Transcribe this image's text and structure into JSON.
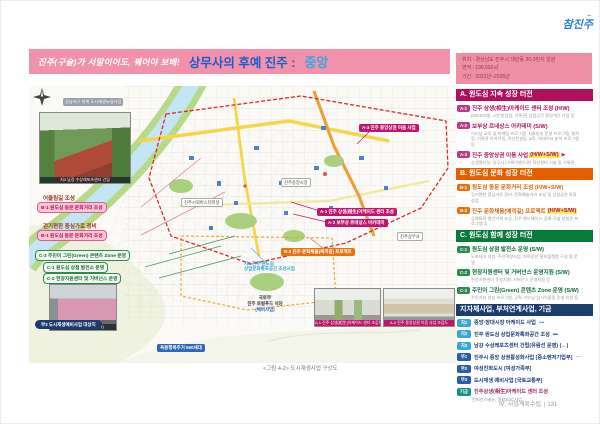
{
  "logo": {
    "text": "참진주"
  },
  "header": {
    "slogan": "진주(구슬)가 서말이어도, 꿰어야 보배!",
    "title": "상무사의 후예 진주 :",
    "title_highlight": "중앙",
    "info": {
      "lines": [
        "위치 : 경상남도 진주시 대안동 30-3번지 일원",
        "면적 : 199,692㎡",
        "기간 : 2022년~2026년"
      ]
    }
  },
  "panel": {
    "a": {
      "title": "A. 원도심 지속 성장 터전",
      "items": [
        {
          "badge": "A-1",
          "title": "진주 상생(相生)아케이드 센터 조성 (H/W)",
          "hl": "",
          "mark": "",
          "desc": "(MICE지원, 시민창업샵, 기록관) 상업공간 환경개선 사업 등"
        },
        {
          "badge": "A-2",
          "title": "보부상 르네상스 아카데미 (S/W)",
          "hl": "",
          "mark": "",
          "desc": "이러닝 교육 및 마케팅 프로그램, 자율방송 운영 프로그램, 컬처링, 기록관 아카이빙, 혁신컨설팅 교육, 빅데이터 분석 프로그램 등"
        },
        {
          "badge": "A-3",
          "title": "진주 중앙상권 이음 사업",
          "hl": "(H/W+S/W)",
          "mark": "▶",
          "desc": "상생멀티실, 상무사 (기록이벤트관) 혁신센터 시설 및 기록관"
        }
      ]
    },
    "b": {
      "title": "B. 원도심 문화 성장 터전",
      "items": [
        {
          "badge": "B-1",
          "title": "원도심 동문 문화거리 조성 (H/W+S/W)",
          "hl": "",
          "mark": "",
          "desc": "걷기편한 중심가로 정비, 문화예술거리 조성 및 상설공연 특화상점"
        },
        {
          "badge": "B-2",
          "title": "진주 문화채움(예끼길) 프로젝트",
          "hl": "(H/W+S/W)",
          "mark": "",
          "desc": "공예특화 청년가게 조성, 진주 핸드메이드·공예·구슬 실험존 프로그램 등"
        }
      ]
    },
    "c": {
      "title": "C. 원도심 함께 성장 터전",
      "items": [
        {
          "badge": "C-1",
          "title": "원도심 상점 발전소 운영 (S/W)",
          "hl": "",
          "mark": "",
          "desc": "노포테크 지원, 주민역량사업, 지역상인 홍보플랫폼 구성 및 운영"
        },
        {
          "badge": "C-2",
          "title": "현장지원센터 및 거버넌스 운영지원 (S/W)",
          "hl": "",
          "mark": "",
          "desc": "현장지원센터 운영지원, 거버넌스 운영지원 등"
        },
        {
          "badge": "C-3",
          "title": "주민이 그린(Green) 콘텐츠 Zone 운영 (S/W)",
          "hl": "",
          "mark": "",
          "desc": "주민기자 양성 프로그램, 공톡·가드닝·업사이클링 운영 지원 등"
        }
      ]
    },
    "d": {
      "title": "지자체사업, 부처연계사업, 기금",
      "items": [
        {
          "badge": "지1",
          "text": "중앙·장대시장 아케이드 사업",
          "mark": "⊶"
        },
        {
          "badge": "지2",
          "text": "진주 원도심 상업문화특화공간 조성",
          "mark": "▬"
        },
        {
          "badge": "지3",
          "text": "남강 수상레포츠센터 건립(유람선 운영) (←)",
          "mark": ""
        },
        {
          "badge": "부1",
          "text": "진주시 중앙 상권활성화사업 [중소벤처기업부]",
          "mark": "╌╌"
        },
        {
          "badge": "부2",
          "text": "여성친화도시 [여성가족부]",
          "mark": ""
        },
        {
          "badge": "부3",
          "text": "도시재생 예비사업 [국토교통부]",
          "mark": ""
        }
      ],
      "fund": {
        "badge": "기금",
        "text": "진주상생(相生)아케이드 센터 조성",
        "desc": "컨퍼런스베뉴, 생활SOC사업"
      }
    }
  },
  "left": {
    "gangnam_badge": "강남지구 연계 도시재생뉴딜사업",
    "photo1_caption": "지3 남강 수상레포츠센터 건립",
    "note1": "어울림길 조성",
    "badge1": "B-1 원도심 동문 문화거리 조성",
    "note2": "걷기편한 중심가로 정비",
    "badge2": "B-1 원도심 동문 문화거리 조성",
    "c3_badge": "C-3 주민이 그린(Green) 콘텐츠 Zone 운영",
    "c1_badge": "C-1 원도심 상점 발전소 운영",
    "c2_badge": "C-2 현장지원센터 및 거버넌스 운영",
    "photo2_caption": "현장지원센터(+마을센터)",
    "bu3_pill": "부3 도시재생예비사업 대상지"
  },
  "map": {
    "badges": {
      "bus_terminal": "진주시외버스터미널",
      "market": "진주중앙시장",
      "sangmusa": "진주상무사",
      "a3": "A-3 진주 중앙상권 이음 사업",
      "a1": "A-1 진주 상생(相生)아케이드 센터 조성",
      "a2": "A-2 보부상 르네상스 아카데미",
      "b2": "B-2 진주 문화채움(예끼길) 프로젝트",
      "ji2_line1": "지2 진주 원도심",
      "ji2_line2": "상업문화특화공간 조성사업",
      "okbong": "옥봉행복주거 500세대",
      "localfood_line1": "국토부",
      "localfood_line2": "진주 로컬푸드 식당",
      "localfood_line3": "(예비사업)"
    },
    "photo3_caption": "A-1 진주 상생(相生)아케이드 센터 조감도",
    "photo4_caption": "A-3 진주 중앙상권 이음 사업 조감도",
    "caption": "<그림 4-2> 도시재생사업 구상도"
  },
  "footer": {
    "text": "Ⅳ. 사업계획수립 ∣ 131"
  }
}
